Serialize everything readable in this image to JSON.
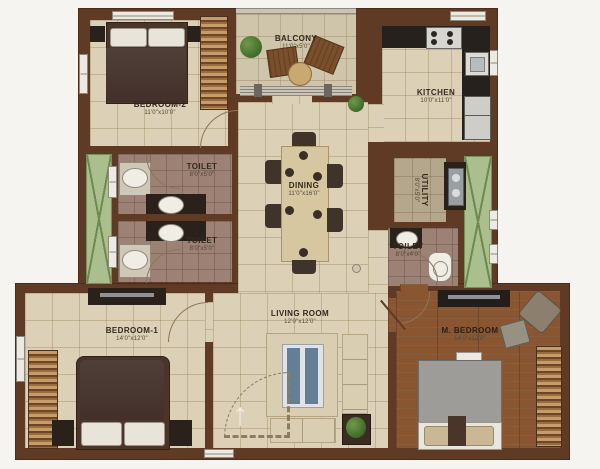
{
  "rooms": {
    "bedroom2": {
      "label": "BEDROOM-2",
      "dims": "11'0\"x10'0\""
    },
    "balcony": {
      "label": "BALCONY",
      "dims": "11'0\"x5'0\""
    },
    "kitchen": {
      "label": "KITCHEN",
      "dims": "10'0\"x11'0\""
    },
    "toilet1": {
      "label": "TOILET",
      "dims": "8'0\"x5'0\""
    },
    "toilet2": {
      "label": "TOILET",
      "dims": "8'0\"x5'0\""
    },
    "dining": {
      "label": "DINING",
      "dims": "11'0\"x16'0\""
    },
    "utility": {
      "label": "UTILITY",
      "dims": "8'0\"x5'0\""
    },
    "toilet3": {
      "label": "TOILET",
      "dims": "8'0\"x4'0\""
    },
    "bedroom1": {
      "label": "BEDROOM-1",
      "dims": "14'0\"x12'0\""
    },
    "living": {
      "label": "LIVING ROOM",
      "dims": "12'0\"x12'0\""
    },
    "mbedroom": {
      "label": "M. BEDROOM",
      "dims": "14'0\"x12'0\""
    }
  },
  "icons": {
    "entry_arrow": "↑"
  },
  "colors": {
    "wall": "#5f3b26",
    "floor": "#dcd1b6",
    "toilet_floor": "#9c8174",
    "wood": "#8a5632",
    "duct_green": "#abbe8e",
    "counter": "#26211d"
  }
}
